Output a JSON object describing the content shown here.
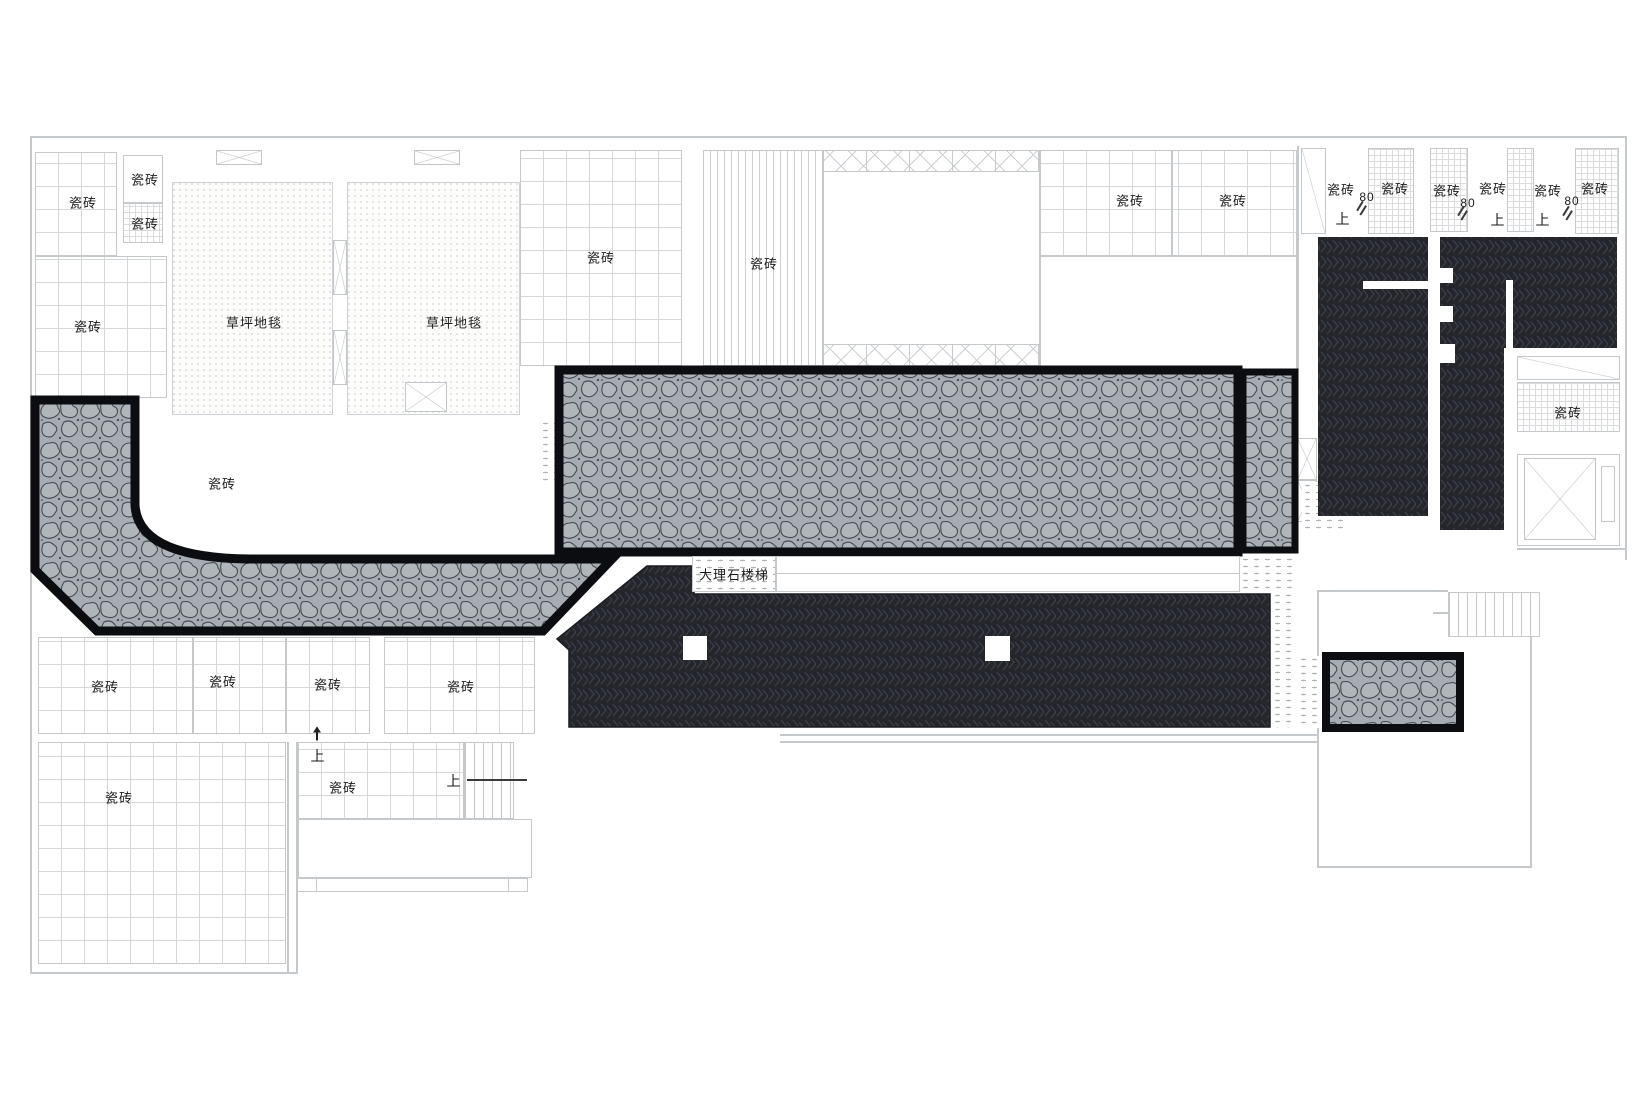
{
  "materials": {
    "tile": "瓷砖",
    "lawn_carpet": "草坪地毯",
    "marble_stairs": "大理石楼梯",
    "up": "上",
    "dim_80": "80"
  },
  "colors": {
    "cobble_base": "#a6acb1",
    "cobble_stone_outline": "#464b52",
    "dark_floor": "#24262c",
    "dark_floor_pattern": "#3c4049",
    "black_border": "#0c0d10",
    "wall_line": "#c6c9cc",
    "grid_line": "#d5d8da",
    "text": "#1a1a1a"
  },
  "annotations": [
    {
      "text": "瓷砖",
      "x": 83,
      "y": 202,
      "fs": 13
    },
    {
      "text": "瓷砖",
      "x": 145,
      "y": 179,
      "fs": 13
    },
    {
      "text": "瓷砖",
      "x": 145,
      "y": 223,
      "fs": 13
    },
    {
      "text": "瓷砖",
      "x": 88,
      "y": 326,
      "fs": 13
    },
    {
      "text": "草坪地毯",
      "x": 254,
      "y": 322,
      "fs": 13
    },
    {
      "text": "草坪地毯",
      "x": 454,
      "y": 322,
      "fs": 13
    },
    {
      "text": "瓷砖",
      "x": 601,
      "y": 257,
      "fs": 13
    },
    {
      "text": "瓷砖",
      "x": 764,
      "y": 263,
      "fs": 13
    },
    {
      "text": "瓷砖",
      "x": 1130,
      "y": 200,
      "fs": 13
    },
    {
      "text": "瓷砖",
      "x": 1233,
      "y": 200,
      "fs": 13
    },
    {
      "text": "瓷砖",
      "x": 222,
      "y": 483,
      "fs": 13
    },
    {
      "text": "大理石楼梯",
      "x": 734,
      "y": 574,
      "fs": 13
    },
    {
      "text": "瓷砖",
      "x": 105,
      "y": 686,
      "fs": 13
    },
    {
      "text": "瓷砖",
      "x": 223,
      "y": 681,
      "fs": 13
    },
    {
      "text": "瓷砖",
      "x": 328,
      "y": 684,
      "fs": 13
    },
    {
      "text": "瓷砖",
      "x": 461,
      "y": 686,
      "fs": 13
    },
    {
      "text": "瓷砖",
      "x": 119,
      "y": 797,
      "fs": 13
    },
    {
      "text": "瓷砖",
      "x": 343,
      "y": 787,
      "fs": 13
    },
    {
      "text": "瓷砖",
      "x": 1568,
      "y": 412,
      "fs": 13
    },
    {
      "text": "瓷砖",
      "x": 1341,
      "y": 189,
      "fs": 13
    },
    {
      "text": "瓷砖",
      "x": 1395,
      "y": 188,
      "fs": 13
    },
    {
      "text": "瓷砖",
      "x": 1447,
      "y": 190,
      "fs": 13
    },
    {
      "text": "瓷砖",
      "x": 1493,
      "y": 188,
      "fs": 13
    },
    {
      "text": "瓷砖",
      "x": 1548,
      "y": 190,
      "fs": 13
    },
    {
      "text": "瓷砖",
      "x": 1595,
      "y": 188,
      "fs": 13
    },
    {
      "text": "80",
      "x": 1367,
      "y": 197,
      "fs": 12
    },
    {
      "text": "80",
      "x": 1468,
      "y": 203,
      "fs": 12
    },
    {
      "text": "80",
      "x": 1572,
      "y": 201,
      "fs": 12
    },
    {
      "text": "上",
      "x": 1343,
      "y": 219,
      "fs": 14
    },
    {
      "text": "上",
      "x": 1498,
      "y": 220,
      "fs": 14
    },
    {
      "text": "上",
      "x": 1543,
      "y": 220,
      "fs": 14
    },
    {
      "text": "上",
      "x": 318,
      "y": 756,
      "fs": 14
    },
    {
      "text": "上",
      "x": 454,
      "y": 781,
      "fs": 14
    }
  ],
  "marks": [
    {
      "type": "up-arrow",
      "x": 317,
      "y": 734
    },
    {
      "type": "dash-right",
      "x": 497,
      "y": 780,
      "w": 60
    },
    {
      "type": "slash",
      "x": 1360,
      "y": 206
    },
    {
      "type": "slash",
      "x": 1461,
      "y": 211
    },
    {
      "type": "slash",
      "x": 1566,
      "y": 211
    }
  ]
}
